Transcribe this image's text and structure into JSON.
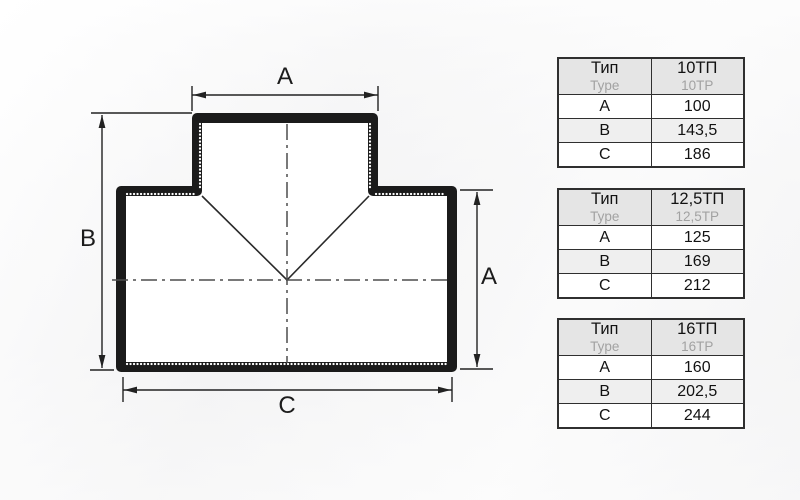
{
  "diagram": {
    "dim_top_label": "A",
    "dim_left_label": "B",
    "dim_right_label": "A",
    "dim_bottom_label": "C"
  },
  "tables": [
    {
      "header": {
        "type_label": "Тип",
        "type_label_en": "Type",
        "model": "10ТП",
        "model_en": "10TP"
      },
      "rows": [
        {
          "param": "A",
          "value": "100"
        },
        {
          "param": "B",
          "value": "143,5"
        },
        {
          "param": "C",
          "value": "186"
        }
      ]
    },
    {
      "header": {
        "type_label": "Тип",
        "type_label_en": "Type",
        "model": "12,5ТП",
        "model_en": "12,5TP"
      },
      "rows": [
        {
          "param": "A",
          "value": "125"
        },
        {
          "param": "B",
          "value": "169"
        },
        {
          "param": "C",
          "value": "212"
        }
      ]
    },
    {
      "header": {
        "type_label": "Тип",
        "type_label_en": "Type",
        "model": "16ТП",
        "model_en": "16TP"
      },
      "rows": [
        {
          "param": "A",
          "value": "160"
        },
        {
          "param": "B",
          "value": "202,5"
        },
        {
          "param": "C",
          "value": "244"
        }
      ]
    }
  ],
  "colors": {
    "outline": "#1b1b1b",
    "thin_line": "#2a2a2a",
    "centerline": "#4d4d4d",
    "table_border": "#2f2f2f",
    "header_bg": "#e5e5e5",
    "alt_row_bg": "#efefef",
    "secondary_text": "#a2a2a2"
  }
}
